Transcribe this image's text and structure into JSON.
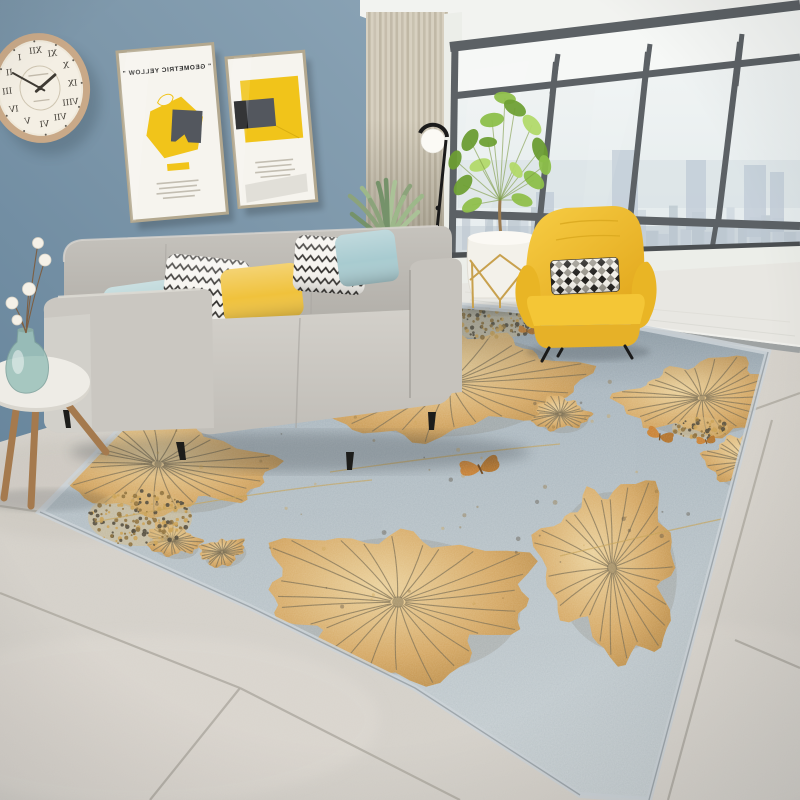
{
  "scene": {
    "description": "Bright modern living room product photo: gray fabric sofa with patterned pillows, yellow wingback armchair, gold lotus-leaf area rug on gray tile floor, blue wall with round roman-numeral clock and two geometric art posters, beige curtain, black floor lamp, fiddle-leaf fig plant, and floor-to-ceiling windows with a hazy city skyline",
    "palette": {
      "wall": "#7d97aa",
      "wallDeep": "#67859c",
      "wallLight": "#8ca5b7",
      "ceiling": "#f2f3f0",
      "curtain": "#d7d0c0",
      "curtainDark": "#b3aa97",
      "casing": "#eceee9",
      "frame": "#5c6165",
      "frameDark": "#4b4f52",
      "glassTop": "#f4f7f6",
      "glassMid": "#e3eaec",
      "city1": "#ccd6dd",
      "city2": "#b9c5ce",
      "marble": "#e8e7e2",
      "threshold": "#9fa3a3",
      "tile": "#d4d0c9",
      "tileLight": "#ded9d2",
      "grout": "#b2aea5",
      "rugBase": "#a4b2bc",
      "rugMid": "#b7c2c8",
      "rugLight": "#cbd3d6",
      "rugBorder": "#ccd4d8",
      "gold1": "#eed298",
      "gold2": "#d6a55c",
      "gold3": "#ae7b30",
      "vein": "#75674a",
      "goldLine": "#c29c4d",
      "sofa": "#c8c5bf",
      "sofaDark": "#aeaba5",
      "sofaLight": "#d6d3cd",
      "pillowAqua": "#b5d3d5",
      "pillowAqua2": "#a8cbd0",
      "pillowYellow": "#f0c23c",
      "pillowWhite": "#f6f4ef",
      "zigzagInk": "#2e2c29",
      "chairYellow": "#f2c232",
      "chairYellowDark": "#dfa81f",
      "wood": "#a57a4e",
      "woodDark": "#8a6239",
      "clockFrame": "#c9a988",
      "clockFace": "#f4efe4",
      "ink": "#3f3b34",
      "posterPaper": "#f6f4ee",
      "posterYellow": "#f1c41a",
      "posterGray": "#53575e",
      "posterFrame": "#b3a88f",
      "plant1": "#8fbf4b",
      "plant2": "#6fa035",
      "plant3": "#b2d96a",
      "plantGray": "#8ca37b",
      "pot": "#f3f1ea",
      "goldWire": "#c8a14e",
      "vaseGlass": "#9dc2bb",
      "lamp": "#1b1b1b",
      "globe": "#fbfaf5",
      "butterfly": "#c97a26",
      "cotton": "#f5f1e8",
      "shadow": "#2c3238"
    },
    "clock": {
      "numerals": [
        "XII",
        "I",
        "II",
        "III",
        "IV",
        "V",
        "VI",
        "VII",
        "VIII",
        "IX",
        "X",
        "XI"
      ],
      "hour_deg": 304.5,
      "minute_deg": 54,
      "mirrored": true
    },
    "posters": {
      "p1_title": "\" GEOMETRIC YELLOW \"",
      "p1_mirrored": true
    },
    "window": {
      "towers": [
        [
          612,
          150,
          26,
          88
        ],
        [
          686,
          160,
          20,
          70
        ],
        [
          744,
          165,
          22,
          72
        ],
        [
          770,
          172,
          14,
          60
        ],
        [
          536,
          192,
          18,
          52
        ]
      ],
      "buildings_n": 30
    },
    "floor": {
      "grout_lines": [
        [
          0,
          506,
          55,
          514
        ],
        [
          0,
          593,
          240,
          688
        ],
        [
          240,
          688,
          460,
          800
        ],
        [
          240,
          688,
          150,
          800
        ],
        [
          772,
          420,
          668,
          800
        ],
        [
          735,
          640,
          800,
          668
        ],
        [
          747,
          412,
          800,
          393
        ]
      ]
    },
    "rug": {
      "leaves": [
        {
          "x": 450,
          "y": 383,
          "rx": 118,
          "ry": 52,
          "rot": -4,
          "seed": 1
        },
        {
          "x": 158,
          "y": 464,
          "rx": 102,
          "ry": 46,
          "rot": 7,
          "seed": 2
        },
        {
          "x": 398,
          "y": 602,
          "rx": 126,
          "ry": 72,
          "rot": 2,
          "seed": 3
        },
        {
          "x": 612,
          "y": 568,
          "rx": 64,
          "ry": 84,
          "rot": -8,
          "seed": 4
        },
        {
          "x": 702,
          "y": 398,
          "rx": 74,
          "ry": 36,
          "rot": -3,
          "seed": 5
        },
        {
          "x": 748,
          "y": 462,
          "rx": 40,
          "ry": 27,
          "rot": 14,
          "seed": 6
        },
        {
          "x": 560,
          "y": 414,
          "rx": 27,
          "ry": 16,
          "rot": 0,
          "seed": 7
        },
        {
          "x": 172,
          "y": 540,
          "rx": 26,
          "ry": 15,
          "rot": 10,
          "seed": 8
        },
        {
          "x": 222,
          "y": 552,
          "rx": 22,
          "ry": 13,
          "rot": -12,
          "seed": 9
        }
      ],
      "speckles": [
        {
          "x": 488,
          "y": 323,
          "rx": 52,
          "ry": 16,
          "seed": 11,
          "n": 110,
          "blob": true
        },
        {
          "x": 140,
          "y": 518,
          "rx": 52,
          "ry": 28,
          "seed": 12,
          "n": 150,
          "blob": true
        },
        {
          "x": 700,
          "y": 428,
          "rx": 28,
          "ry": 11,
          "seed": 13,
          "n": 50,
          "blob": true
        },
        {
          "x": 430,
          "y": 480,
          "rx": 280,
          "ry": 150,
          "seed": 14,
          "n": 70,
          "blob": false
        }
      ],
      "butterflies": [
        {
          "x": 480,
          "y": 468,
          "s": 1.25,
          "rot": -12
        },
        {
          "x": 660,
          "y": 436,
          "s": 0.85,
          "rot": 18
        },
        {
          "x": 706,
          "y": 441,
          "s": 0.6,
          "rot": -6
        },
        {
          "x": 527,
          "y": 331,
          "s": 0.55,
          "rot": 8
        }
      ],
      "accent_lines": [
        [
          95,
          522,
          250,
          492,
          372,
          480
        ],
        [
          560,
          556,
          660,
          532,
          745,
          514
        ],
        [
          330,
          472,
          470,
          452,
          560,
          444
        ]
      ]
    }
  }
}
